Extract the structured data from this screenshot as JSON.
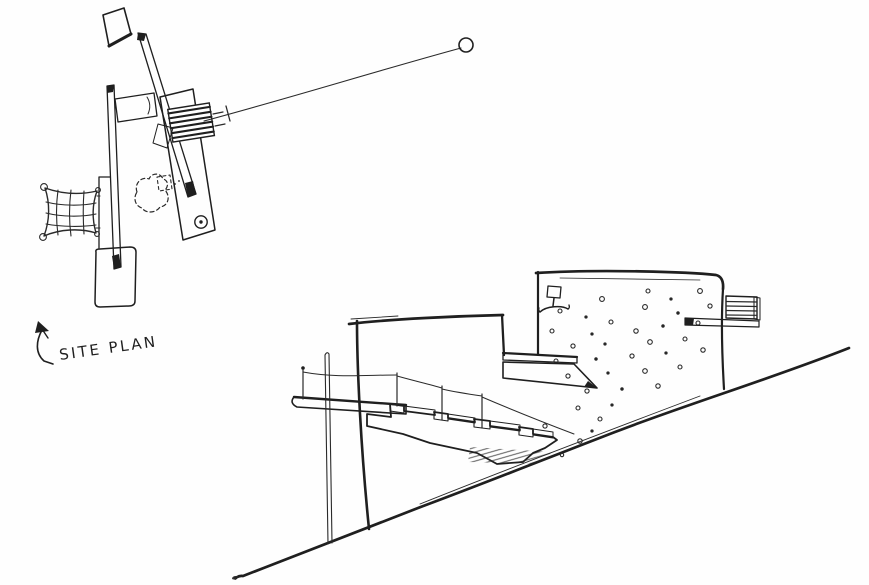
{
  "page": {
    "background_color": "#fefefe",
    "ink_color": "#1f1f1f"
  },
  "labels": {
    "site_plan": "SITE PLAN"
  },
  "drawings": {
    "site_plan": {
      "caption": "SITE PLAN",
      "icons": [
        "north-arrow-icon",
        "pin-marker-icon"
      ]
    },
    "section": {
      "icons": [
        "roof-lamp-icon"
      ]
    }
  }
}
